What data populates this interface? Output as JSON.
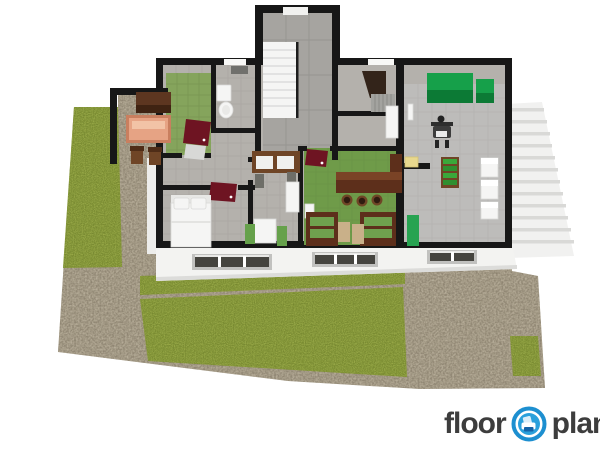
{
  "logo": {
    "text_left": "floor",
    "text_right": "planner",
    "icon": "floorplanner-armchair-icon"
  },
  "colors": {
    "bg": "#ffffff",
    "grass": "#8fa13f",
    "grassSpeckle": "#37490e",
    "grassLight": "#b9c45e",
    "gravel": "#a79d88",
    "gravelSpeckle": "#554d3d",
    "gravelLight": "#d8d0bd",
    "wall": "#171717",
    "floor": "#b4b1ac",
    "floorHall": "#a6a4a0",
    "floorGreen": "#85a45c",
    "floorKitchen": "#6f9b49",
    "floorGarage": "#bdbcba",
    "tileLine": "#9d9a94",
    "facade": "#f3f3f1",
    "facadeShade": "#dcdcda",
    "stepBg": "#f1f1f0",
    "stepLine": "#d9d9d7",
    "windowFrame": "#c1c1bf",
    "windowDark": "#45443f",
    "door": "#6e1422",
    "cabinetGreen": "#16a04a",
    "cabinetGreenDark": "#0c7a35",
    "woodDark": "#4f2d17",
    "woodMid": "#6f4526",
    "woodBar": "#5d2f1b",
    "woodBarTop": "#7a4326",
    "salmon": "#e6a384",
    "salmonEdge": "#c97f5f",
    "furnWhite": "#f5f5f4",
    "furnStroke": "#d9d9d7",
    "speaker": "#6e6e68",
    "chairGreen": "#66a14b",
    "cushionGreen": "#6fa14e",
    "tanChair": "#c9b089",
    "matGreen": "#27a351",
    "plantGreen": "#3aa83a",
    "plantGreenDark": "#2f8f2f",
    "yellow": "#e8d88e",
    "basementDark": "#33241a",
    "mirrorGrey": "#70706c",
    "railing": "#1d1d1d",
    "logoText": "#3d3d3d",
    "logoBlue": "#1d8fd0",
    "logoBlueFill": "#2aa0dc",
    "logoChairShade": "#1563a8"
  }
}
